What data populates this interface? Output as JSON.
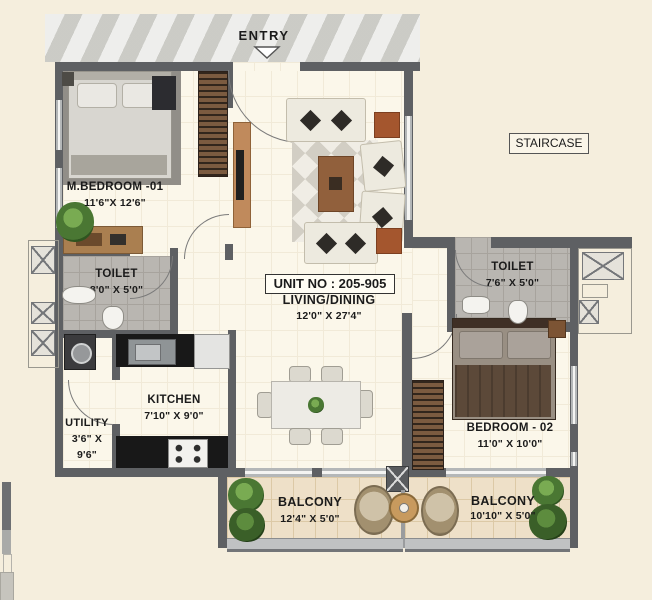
{
  "plan": {
    "entry_label": "ENTRY",
    "staircase_label": "STAIRCASE",
    "unit_no": "UNIT NO : 205-905",
    "rooms": {
      "living": {
        "name": "LIVING/DINING",
        "dims": "12'0\" X 27'4\""
      },
      "m_bedroom": {
        "name": "M.BEDROOM -01",
        "dims": "11'6\"X 12'6\""
      },
      "toilet1": {
        "name": "TOILET",
        "dims": "8'0\" X 5'0\""
      },
      "toilet2": {
        "name": "TOILET",
        "dims": "7'6\" X 5'0\""
      },
      "kitchen": {
        "name": "KITCHEN",
        "dims": "7'10\" X 9'0\""
      },
      "utility": {
        "name": "UTILITY",
        "dims_line1": "3'6\" X",
        "dims_line2": "9'6\""
      },
      "bedroom2": {
        "name": "BEDROOM - 02",
        "dims": "11'0\" X 10'0\""
      },
      "balcony1": {
        "name": "BALCONY",
        "dims": "12'4\" X 5'0\""
      },
      "balcony2": {
        "name": "BALCONY",
        "dims": "10'10\" X 5'0\""
      }
    },
    "colors": {
      "background": "#f5eedd",
      "wall": "#5e6063",
      "floor": "#fbf7ea",
      "toilet_tile": "#b9b6b1",
      "balcony_tile": "#eee0c8",
      "counter": "#181818",
      "wood": "#9c6b4a",
      "text": "#1b1b1b"
    }
  }
}
